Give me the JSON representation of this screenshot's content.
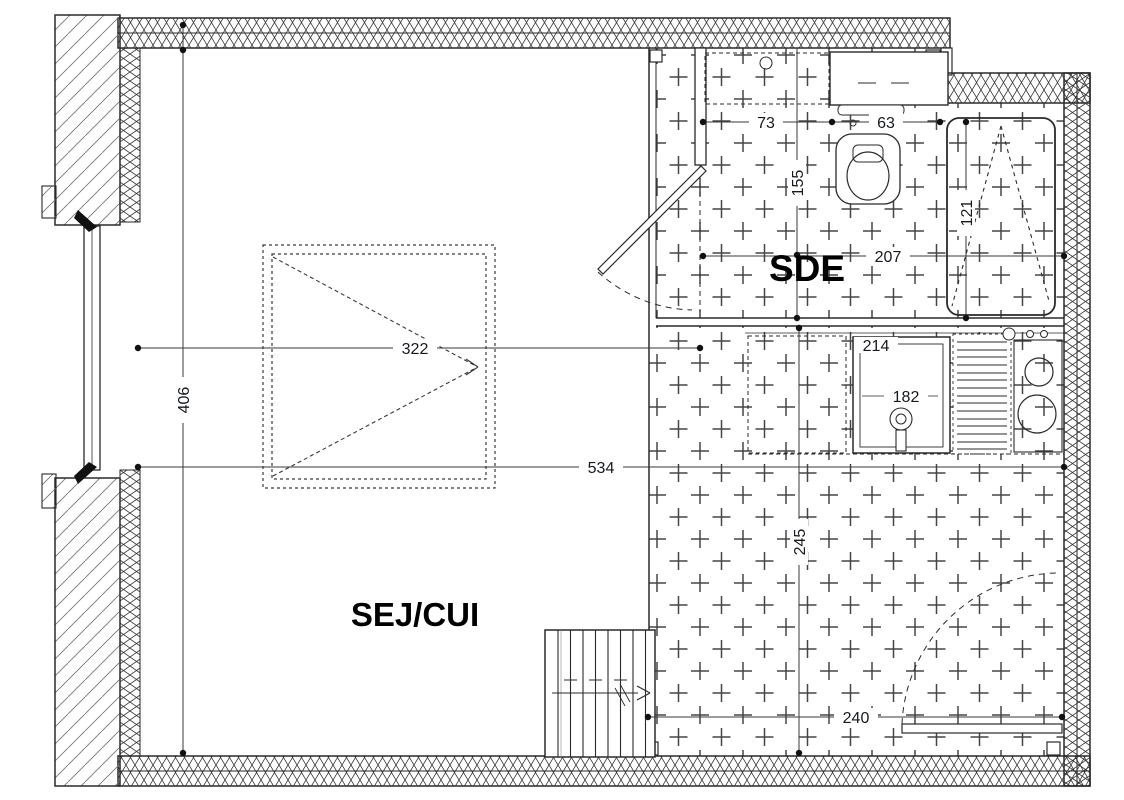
{
  "rooms": {
    "sde": "SDE",
    "sej_cui": "SEJ/CUI"
  },
  "dims": {
    "d73": "73",
    "d63": "63",
    "d155": "155",
    "d121": "121",
    "d207": "207",
    "d322": "322",
    "d406": "406",
    "d214": "214",
    "d182": "182",
    "d534": "534",
    "d245": "245",
    "d240": "240"
  },
  "colors": {
    "background": "#ffffff",
    "wall_line": "#2a2a2a",
    "tile_cross": "#454545",
    "dim_text": "#15181c"
  }
}
